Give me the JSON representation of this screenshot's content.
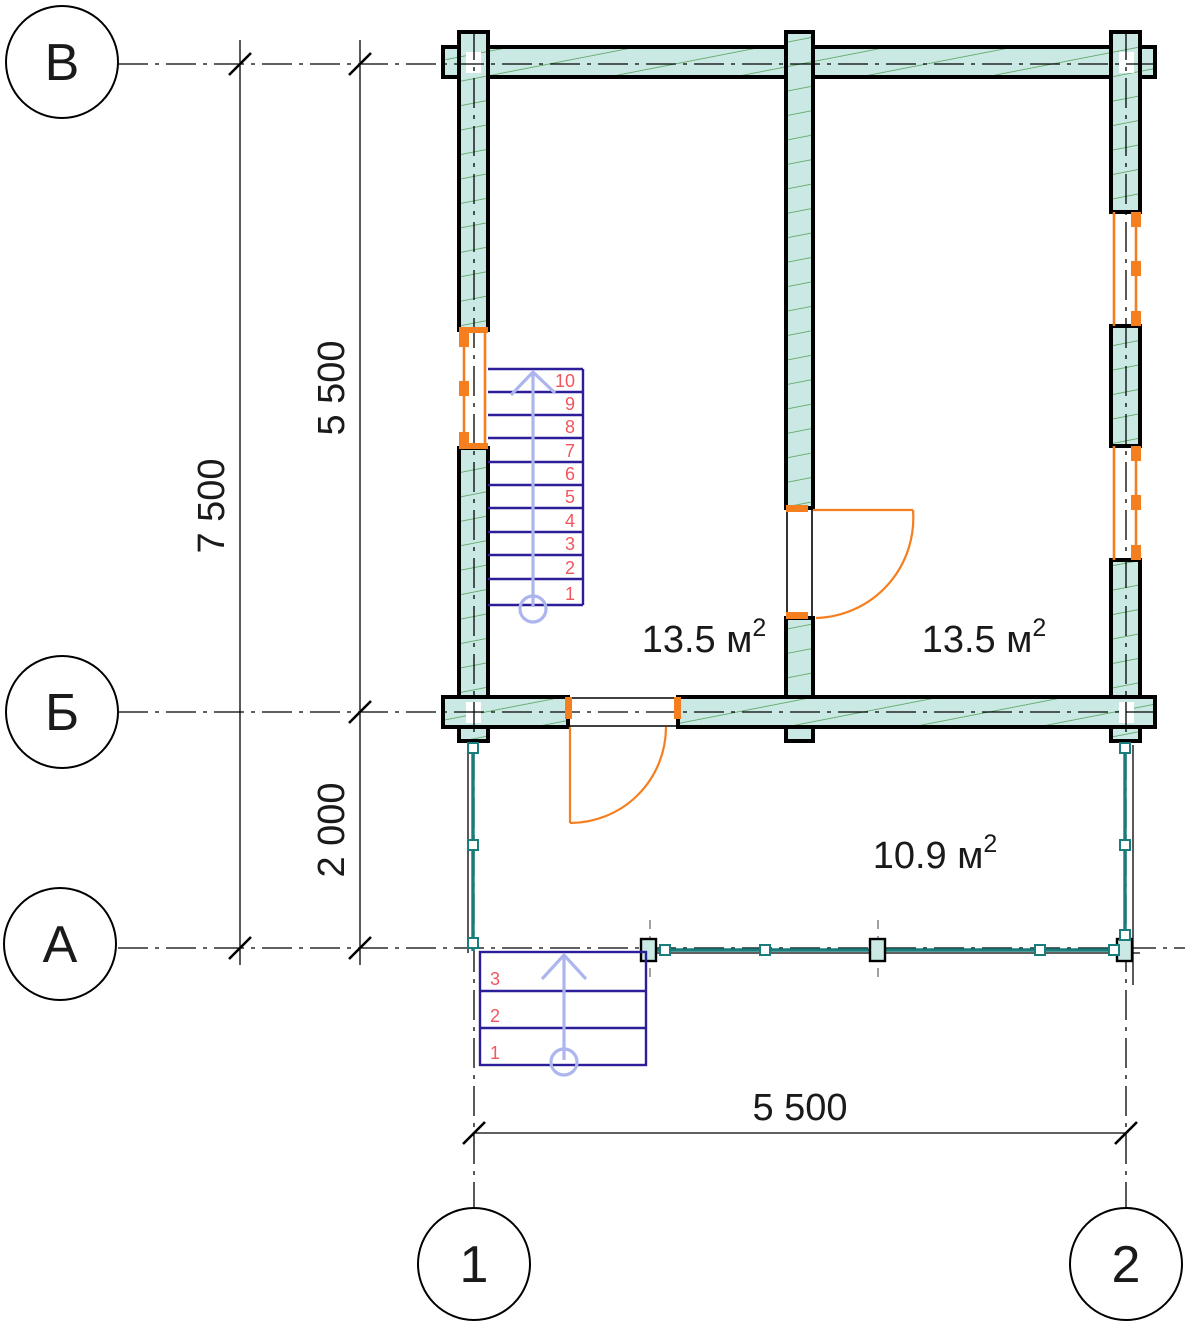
{
  "title": "Floor plan drawing",
  "colors": {
    "wall_fill": "#cbe9e4",
    "hatch": "#4f9c55",
    "window": "#f57e1e",
    "stair_line": "#2c1d99",
    "step_number": "#f2555e",
    "arrow": "#adb5ee",
    "terrace": "#187d7b"
  },
  "axes": {
    "rows": [
      {
        "label": "В"
      },
      {
        "label": "Б"
      },
      {
        "label": "А"
      }
    ],
    "cols": [
      {
        "label": "1"
      },
      {
        "label": "2"
      }
    ]
  },
  "dimensions": {
    "total_height": "7 500",
    "upper_span": "5 500",
    "lower_span": "2 000",
    "width_span": "5 500"
  },
  "rooms": [
    {
      "area": "13.5 м",
      "sup": "2"
    },
    {
      "area": "13.5 м",
      "sup": "2"
    },
    {
      "area": "10.9 м",
      "sup": "2"
    }
  ],
  "stairs": {
    "main": {
      "steps": [
        "1",
        "2",
        "3",
        "4",
        "5",
        "6",
        "7",
        "8",
        "9",
        "10"
      ]
    },
    "porch": {
      "steps": [
        "1",
        "2",
        "3"
      ]
    }
  }
}
